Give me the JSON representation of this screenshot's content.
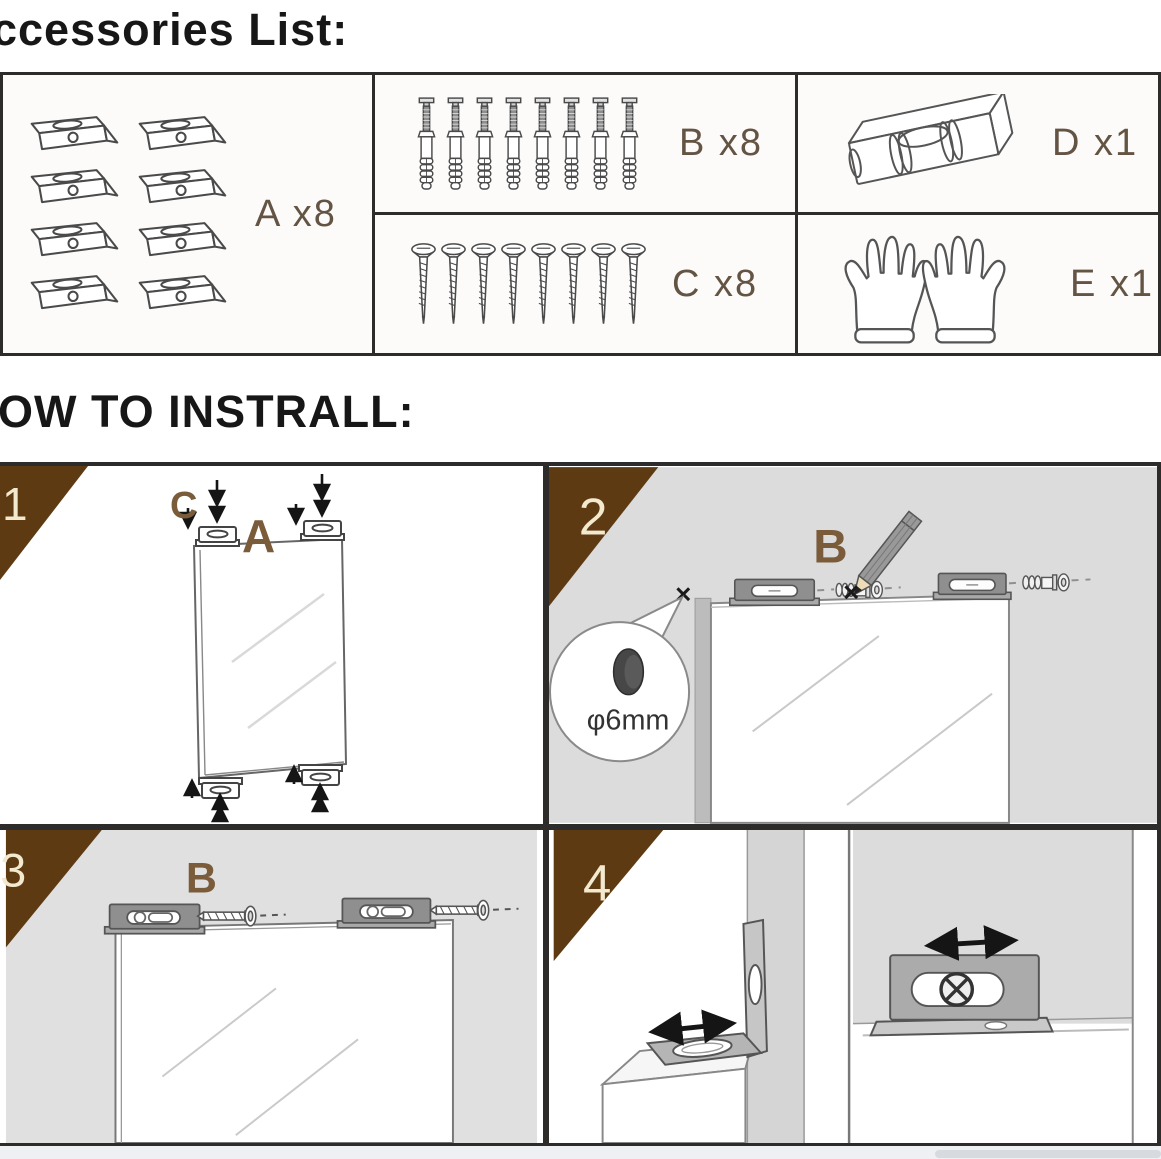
{
  "header": {
    "accessories_title": "ccessories List:",
    "install_title": "OW TO INSTRALL:"
  },
  "accessories": {
    "items": [
      {
        "key": "A",
        "label": "A x8",
        "item_name": "mounting-bracket",
        "count": 8
      },
      {
        "key": "B",
        "label": "B x8",
        "item_name": "expansion-anchor-with-screw",
        "count": 8
      },
      {
        "key": "C",
        "label": "C x8",
        "item_name": "mounting-screw",
        "count": 8
      },
      {
        "key": "D",
        "label": "D x1",
        "item_name": "spirit-level",
        "count": 1
      },
      {
        "key": "E",
        "label": "E x1",
        "item_name": "protective-gloves",
        "count": 1
      }
    ]
  },
  "steps": [
    {
      "number": "1",
      "labels": {
        "c": "C",
        "a": "A"
      }
    },
    {
      "number": "2",
      "labels": {
        "b": "B"
      },
      "marks": {
        "left": "×",
        "right": "×"
      },
      "hole_label": "φ6mm"
    },
    {
      "number": "3",
      "labels": {
        "b": "B"
      }
    },
    {
      "number": "4"
    }
  ],
  "colors": {
    "corner_brown": "#5d3a12",
    "label_brown": "#6e5a3e",
    "number_cream": "#f3e9cf",
    "panel_gray": "#dcdcdc",
    "border_dark": "#2e2c2a"
  }
}
